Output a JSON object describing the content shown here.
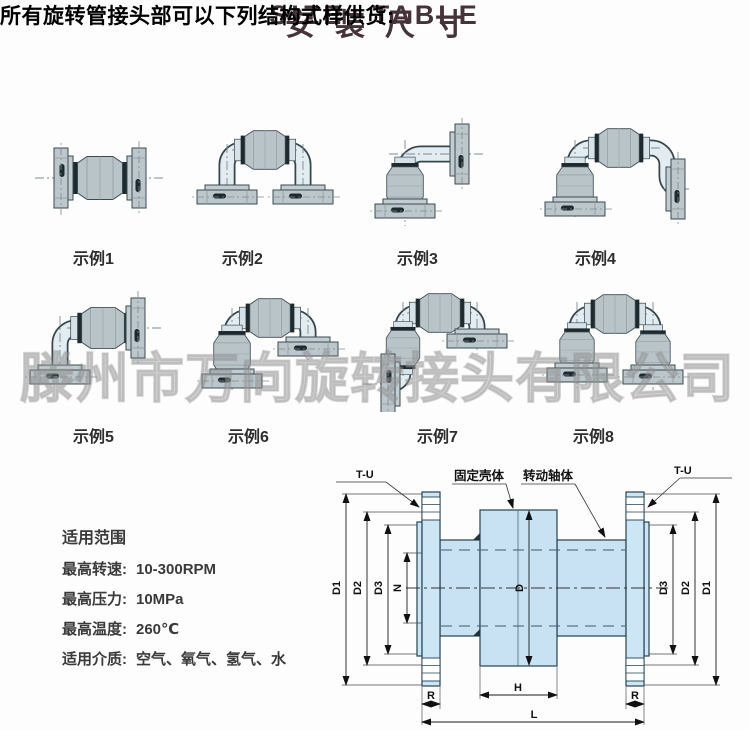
{
  "colors": {
    "accent": "#46333a",
    "bar_mauve": "#9b7d80",
    "bar_gray": "#dcdade",
    "pipe_fill": "#e2ecf1",
    "metal_fill": "#b9c4c9",
    "drawing_blue": "#c8e2f4"
  },
  "header": {
    "title_cn": "安装尺寸",
    "title_en": "SIZE TABLE"
  },
  "intro": "所有旋转管接头部可以下列结构式样供货:",
  "watermark": "滕州市万向旋转接头有限公司",
  "examples": [
    {
      "label": "示例1",
      "style": "straight-inline-double-flange"
    },
    {
      "label": "示例2",
      "style": "u-shape-both-ends-down"
    },
    {
      "label": "示例3",
      "style": "l-shape-90-elbow"
    },
    {
      "label": "示例4",
      "style": "z-shape-double-joint"
    },
    {
      "label": "示例5",
      "style": "l-shape-90-low-flange"
    },
    {
      "label": "示例6",
      "style": "u-shape-joint-on-left-leg"
    },
    {
      "label": "示例7",
      "style": "u-shape-side-outlet-left"
    },
    {
      "label": "示例8",
      "style": "u-shape-joints-both-legs"
    }
  ],
  "specs": {
    "title": "适用范围",
    "items": [
      {
        "label": "最高转速:",
        "value": "10-300RPM"
      },
      {
        "label": "最高压力:",
        "value": "10MPa"
      },
      {
        "label": "最高温度:",
        "value": "260℃"
      },
      {
        "label": "适用介质:",
        "value": "空气、氧气、氢气、水"
      }
    ]
  },
  "drawing": {
    "tu": "T-U",
    "fixed_body": "固定壳体",
    "rotating_shaft": "转动轴体",
    "dims": {
      "d1": "D1",
      "d2": "D2",
      "d3": "D3",
      "n": "N",
      "d": "D",
      "r": "R",
      "h": "H",
      "l": "L"
    }
  }
}
